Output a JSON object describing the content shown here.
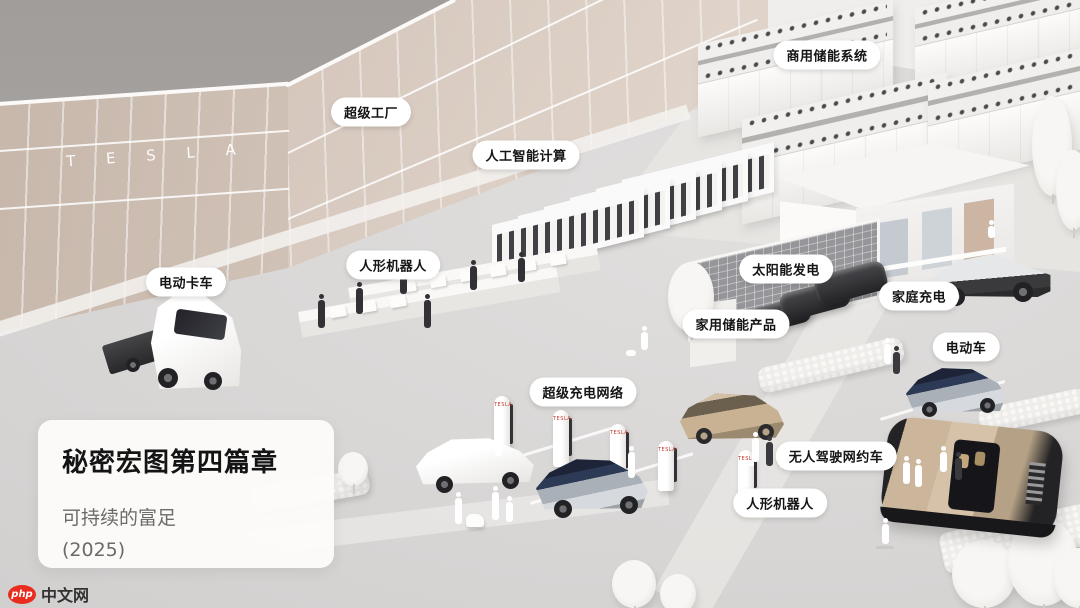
{
  "scene": {
    "factory_logo": "T E S L A",
    "supercharger_brand": "TESLA",
    "labels": [
      {
        "id": "commercial-energy-storage",
        "text": "商用储能系统"
      },
      {
        "id": "gigafactory",
        "text": "超级工厂"
      },
      {
        "id": "ai-computing",
        "text": "人工智能计算"
      },
      {
        "id": "humanoid-robot-factory",
        "text": "人形机器人"
      },
      {
        "id": "electric-truck",
        "text": "电动卡车"
      },
      {
        "id": "solar-power",
        "text": "太阳能发电"
      },
      {
        "id": "home-charging",
        "text": "家庭充电"
      },
      {
        "id": "home-energy-storage",
        "text": "家用储能产品"
      },
      {
        "id": "electric-vehicle",
        "text": "电动车"
      },
      {
        "id": "supercharger-network",
        "text": "超级充电网络"
      },
      {
        "id": "robotaxi",
        "text": "无人驾驶网约车"
      },
      {
        "id": "humanoid-robot-street",
        "text": "人形机器人"
      }
    ],
    "title_card": {
      "title": "秘密宏图第四篇章",
      "subtitle": "可持续的富足",
      "year": "(2025)"
    },
    "watermark": {
      "badge": "php",
      "site": "中文网"
    },
    "colors": {
      "sky": "#a8a4a2",
      "factory_wall": "#d6c7bb",
      "ground": "#d8d6d5",
      "label_bg": "#ffffff",
      "label_text": "#141414",
      "supercharger_text_red": "#c0392b",
      "van_gold": "#cbb69c",
      "car_navy": "#222a42",
      "watermark_red": "#e82c1e"
    }
  }
}
